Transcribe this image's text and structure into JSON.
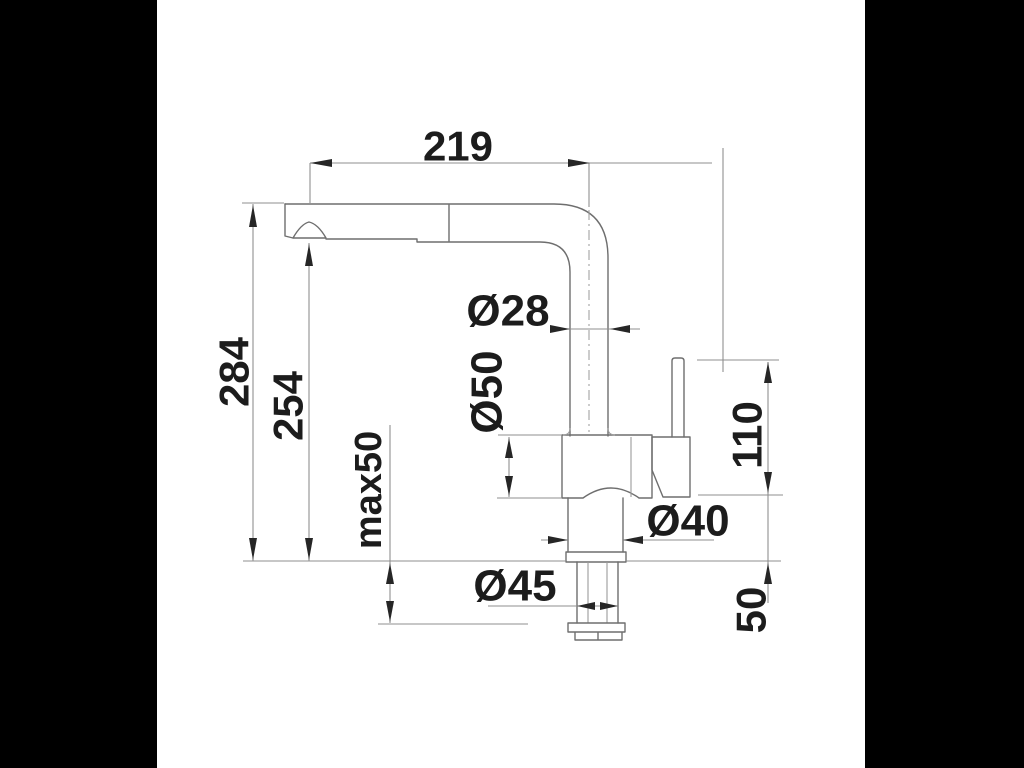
{
  "drawing": {
    "labels": {
      "spout_reach": "219",
      "overall_height": "284",
      "spout_height": "254",
      "max_counter_thickness": "max50",
      "spout_pipe_diameter": "Ø28",
      "body_diameter": "Ø50",
      "base_diameter": "Ø40",
      "mounting_hole_diameter": "Ø45",
      "handle_height": "110",
      "base_section_height": "50"
    },
    "colors": {
      "letterbox": "#000000",
      "paper": "#ffffff",
      "line": "#6e6e6e",
      "dimension_line": "#8f8f8f",
      "text": "#1c1c1c"
    }
  }
}
